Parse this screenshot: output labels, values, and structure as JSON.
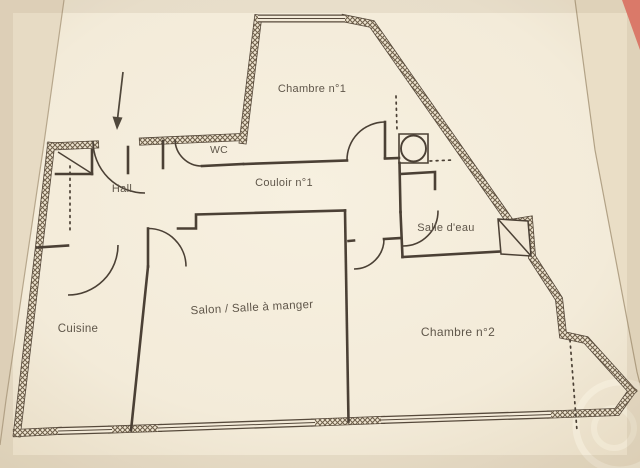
{
  "plan": {
    "rooms": {
      "chambre1": {
        "label": "Chambre n°1"
      },
      "wc": {
        "label": "WC"
      },
      "hall": {
        "label": "Hall"
      },
      "couloir": {
        "label": "Couloir n°1"
      },
      "salle_eau": {
        "label": "Salle d'eau"
      },
      "cuisine": {
        "label": "Cuisine"
      },
      "salon": {
        "label": "Salon / Salle à manger"
      },
      "chambre2": {
        "label": "Chambre n°2"
      }
    },
    "icons": {
      "entrance_arrow": "down-arrow"
    },
    "colors": {
      "paper": "#f5eedd",
      "paper_edge": "#b7a78c",
      "wall_line": "#4b4135",
      "wall_fill": "#efe5d1",
      "label_text": "#5f564a",
      "background": "#e8ddc7",
      "corner_object": "#e4796b"
    }
  }
}
